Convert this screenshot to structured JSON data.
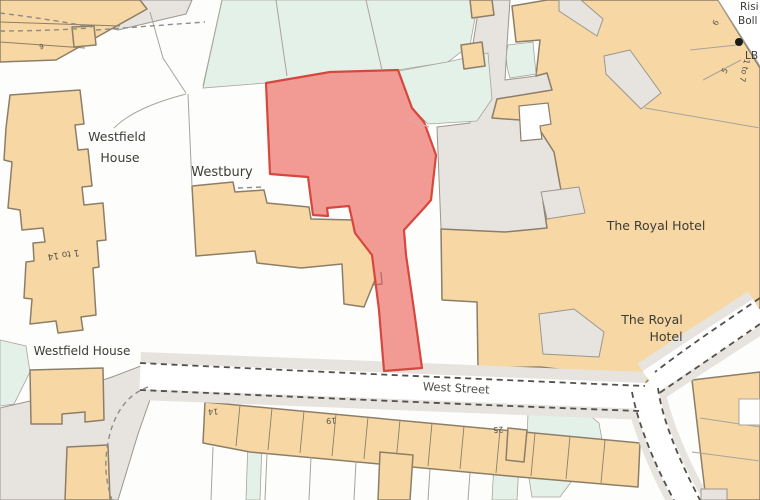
{
  "map": {
    "labels": {
      "westfield_top_1": "Westfield",
      "westfield_top_2": "House",
      "westbury": "Westbury",
      "flats_range": "1 to 14",
      "westfield_bottom": "Westfield House",
      "street": "West Street",
      "hotel_top": "The Royal Hotel",
      "hotel_bottom_1": "The Royal",
      "hotel_bottom_2": "Hotel",
      "edge_1": "Risi",
      "edge_2": "Boll",
      "lb": "LB",
      "num_6_topleft": "6",
      "num_6": "6",
      "num_5": "5",
      "num_range_right": "1 to 7",
      "num_14": "14",
      "num_19": "19",
      "num_25": "25"
    },
    "colors": {
      "bg": "#FDFDFB",
      "green": "#E4F1E8",
      "gray": "#E7E4E0",
      "tan": "#F7D7A4",
      "tan_outline": "#8D7E68",
      "red_fill": "#F29B95",
      "red_stroke": "#D6473D",
      "road_white": "#FFFFFF",
      "dash": "#53504A",
      "hairline": "#A7A49D",
      "text": "#3C3C37",
      "street_text": "#52504B"
    }
  }
}
